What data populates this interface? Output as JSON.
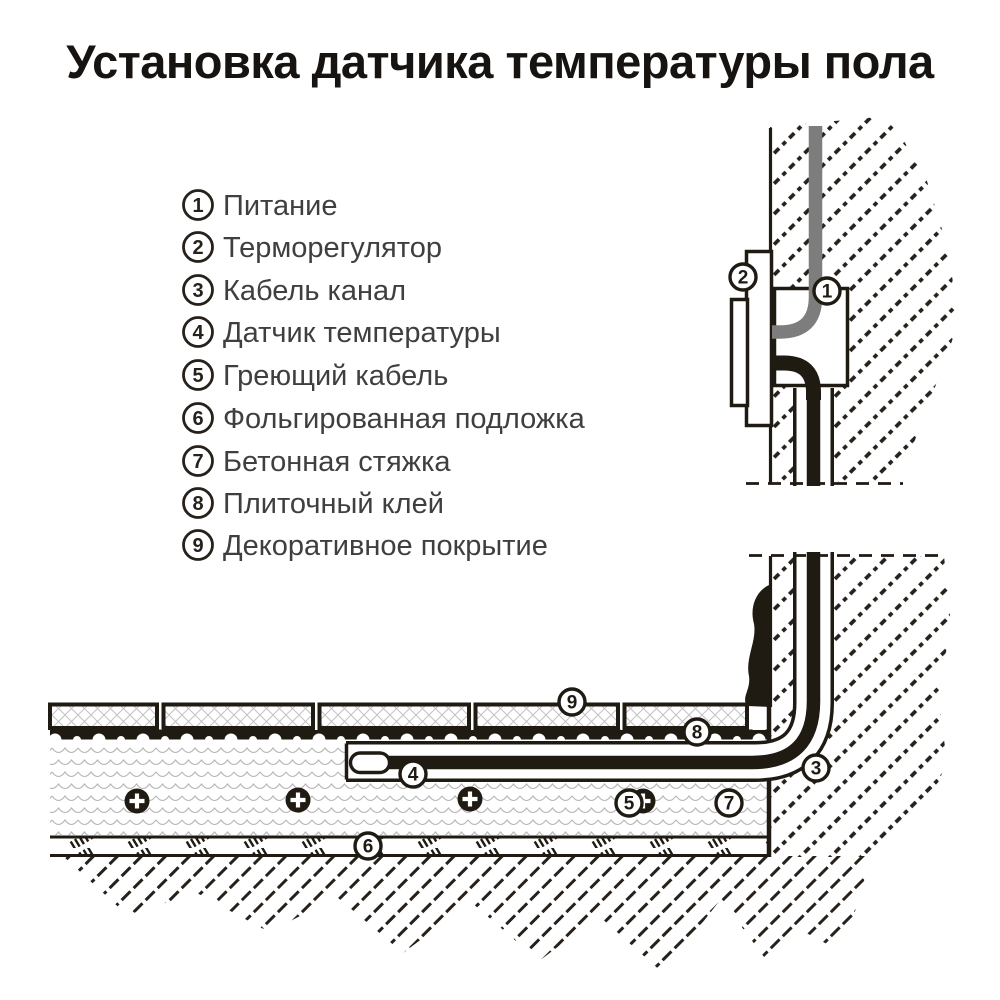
{
  "title": "Установка датчика температуры пола",
  "legend": {
    "items": [
      {
        "num": "1",
        "label": "Питание"
      },
      {
        "num": "2",
        "label": "Терморегулятор"
      },
      {
        "num": "3",
        "label": "Кабель канал"
      },
      {
        "num": "4",
        "label": "Датчик температуры"
      },
      {
        "num": "5",
        "label": "Греющий кабель"
      },
      {
        "num": "6",
        "label": "Фольгированная подложка"
      },
      {
        "num": "7",
        "label": "Бетонная стяжка"
      },
      {
        "num": "8",
        "label": "Плиточный клей"
      },
      {
        "num": "9",
        "label": "Декоративное покрытие"
      }
    ]
  },
  "colors": {
    "ink": "#1f1a12",
    "power_cable_gray": "#7d7d7d",
    "screed_wave_gray": "#b6b6b6",
    "tile_pattern_gray": "#c2c2c2"
  }
}
